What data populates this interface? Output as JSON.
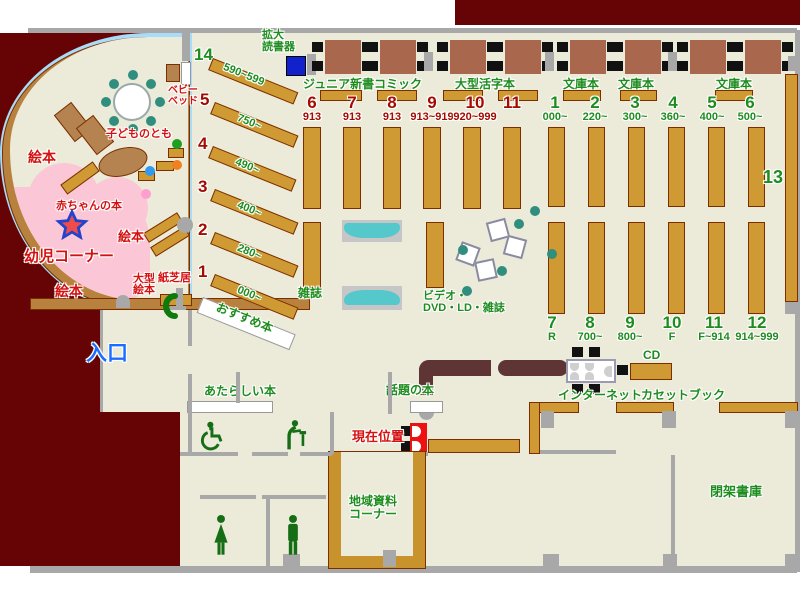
{
  "title": "library-floor-map",
  "colors": {
    "outside": "#660405",
    "floor": "#ecead9",
    "wall": "#a8a8a8",
    "shelf": "#cf9a33",
    "curve_wall": "#b8823e",
    "pink_corner": "#fbc7d7",
    "green_label": "#1e8c1e",
    "maroon_label": "#a30b00",
    "red_label": "#d41111",
    "blue_label": "#1a6eff",
    "teal": "#55c8cc",
    "marker_red": "#ee1111"
  },
  "children_area": {
    "ehon_top": "絵本",
    "kodomo_no_tomo": "子どものとも",
    "baby_bed_line1": "ベビー",
    "baby_bed_line2": "ベッド",
    "akachan": "赤ちゃんの本",
    "ehon_mid": "絵本",
    "yoji_corner": "幼児コーナー",
    "ehon_bottom": "絵本",
    "ogata_line1": "大型",
    "ogata_line2": "絵本",
    "kamishibai": "紙芝居"
  },
  "reader": {
    "line1": "拡大",
    "line2": "読書器"
  },
  "entrance": "入口",
  "osusume": "おすすめ本",
  "left_shelves": [
    {
      "no": "14",
      "range": "590~599"
    },
    {
      "no": "5",
      "range": "750~"
    },
    {
      "no": "4",
      "range": "490~"
    },
    {
      "no": "3",
      "range": "400~"
    },
    {
      "no": "2",
      "range": "280~"
    },
    {
      "no": "1",
      "range": "000~"
    }
  ],
  "table_labels": [
    "ジュニア新書",
    "コミック",
    "大型活字本",
    "文庫本",
    "文庫本",
    "文庫本"
  ],
  "mid_numbers": [
    {
      "no": "6",
      "range": "913"
    },
    {
      "no": "7",
      "range": "913"
    },
    {
      "no": "8",
      "range": "913"
    },
    {
      "no": "9",
      "range": "913~919"
    },
    {
      "no": "10",
      "range": "920~999"
    },
    {
      "no": "11",
      "range": ""
    }
  ],
  "right_numbers": [
    {
      "no": "1",
      "range": "000~"
    },
    {
      "no": "2",
      "range": "220~"
    },
    {
      "no": "3",
      "range": "300~"
    },
    {
      "no": "4",
      "range": "360~"
    },
    {
      "no": "5",
      "range": "400~"
    },
    {
      "no": "6",
      "range": "500~"
    }
  ],
  "bottom_numbers": [
    {
      "no": "7",
      "range": "R"
    },
    {
      "no": "8",
      "range": "700~"
    },
    {
      "no": "9",
      "range": "800~"
    },
    {
      "no": "10",
      "range": "F"
    },
    {
      "no": "11",
      "range": "F~914"
    },
    {
      "no": "12",
      "range": "914~999"
    }
  ],
  "shelf13": "13",
  "magazines": "雑誌",
  "video": {
    "line1": "ビデオ・",
    "line2": "DVD・LD・雑誌"
  },
  "new_books": "あたらしい本",
  "topic_books": "話題の本",
  "current_location": "現在位置",
  "cd": "CD",
  "internet": "インターネット",
  "cassette": "カセットブック",
  "local_docs": {
    "line1": "地域資料",
    "line2": "コーナー"
  },
  "closed_stacks": "閉架書庫"
}
